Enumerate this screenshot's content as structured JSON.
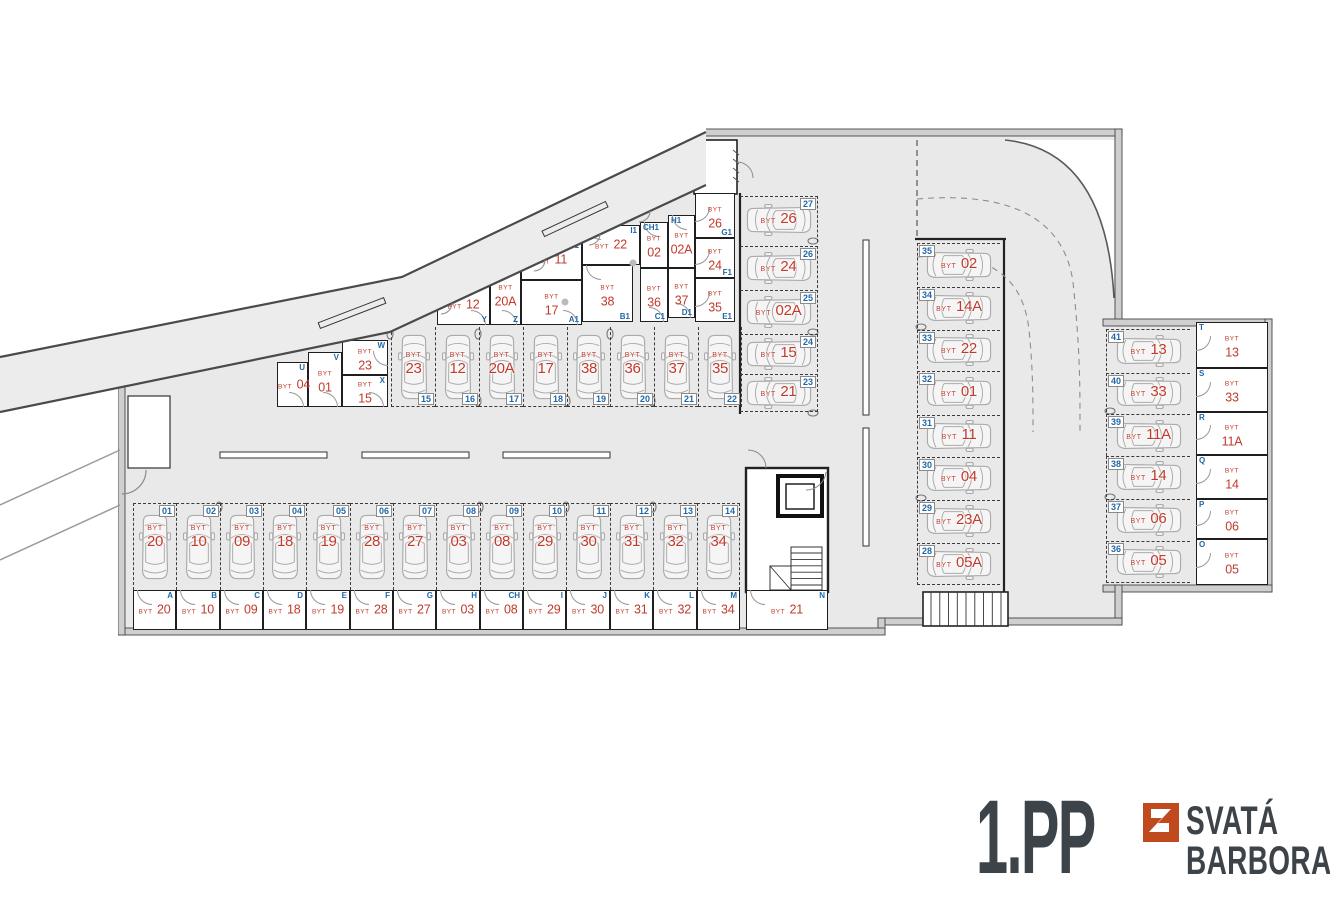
{
  "page": {
    "floor_label": "1.PP",
    "brand_top": "SVATÁ",
    "brand_bottom": "BARBORA"
  },
  "colors": {
    "apt_red": "#c13a2b",
    "code_blue": "#1f67a8",
    "floor_gray": "#e9e9e9",
    "wall_dark": "#3a3a3a",
    "title_gray": "#3d4449",
    "logo_orange": "#c04a1e",
    "car_line": "#ababab"
  },
  "legend": {
    "byt_prefix": "BYT"
  },
  "parking_groups": [
    {
      "id": "row-bottom",
      "orient": "v",
      "chip_pos": "tr",
      "label_mode": "stack",
      "spaces": [
        {
          "num": "01",
          "apt": "20",
          "x": 133,
          "y": 503,
          "w": 43,
          "h": 87
        },
        {
          "num": "02",
          "apt": "10",
          "x": 176,
          "y": 503,
          "w": 44,
          "h": 87
        },
        {
          "num": "03",
          "apt": "09",
          "x": 220,
          "y": 503,
          "w": 43,
          "h": 87
        },
        {
          "num": "04",
          "apt": "18",
          "x": 263,
          "y": 503,
          "w": 43,
          "h": 87
        },
        {
          "num": "05",
          "apt": "19",
          "x": 306,
          "y": 503,
          "w": 44,
          "h": 87
        },
        {
          "num": "06",
          "apt": "28",
          "x": 350,
          "y": 503,
          "w": 43,
          "h": 87
        },
        {
          "num": "07",
          "apt": "27",
          "x": 393,
          "y": 503,
          "w": 43,
          "h": 87
        },
        {
          "num": "08",
          "apt": "03",
          "x": 436,
          "y": 503,
          "w": 44,
          "h": 87
        },
        {
          "num": "09",
          "apt": "08",
          "x": 480,
          "y": 503,
          "w": 43,
          "h": 87
        },
        {
          "num": "10",
          "apt": "29",
          "x": 523,
          "y": 503,
          "w": 43,
          "h": 87
        },
        {
          "num": "11",
          "apt": "30",
          "x": 566,
          "y": 503,
          "w": 44,
          "h": 87
        },
        {
          "num": "12",
          "apt": "31",
          "x": 610,
          "y": 503,
          "w": 43,
          "h": 87
        },
        {
          "num": "13",
          "apt": "32",
          "x": 653,
          "y": 503,
          "w": 44,
          "h": 87
        },
        {
          "num": "14",
          "apt": "34",
          "x": 697,
          "y": 503,
          "w": 43,
          "h": 87
        }
      ]
    },
    {
      "id": "row-middle",
      "orient": "v",
      "chip_pos": "br",
      "label_mode": "stack",
      "spaces": [
        {
          "num": "15",
          "apt": "23",
          "x": 391,
          "y": 327,
          "w": 44,
          "h": 80
        },
        {
          "num": "16",
          "apt": "12",
          "x": 435,
          "y": 327,
          "w": 44,
          "h": 80
        },
        {
          "num": "17",
          "apt": "20A",
          "x": 479,
          "y": 327,
          "w": 44,
          "h": 80
        },
        {
          "num": "18",
          "apt": "17",
          "x": 523,
          "y": 327,
          "w": 44,
          "h": 80
        },
        {
          "num": "19",
          "apt": "38",
          "x": 567,
          "y": 327,
          "w": 43,
          "h": 80
        },
        {
          "num": "20",
          "apt": "36",
          "x": 610,
          "y": 327,
          "w": 44,
          "h": 80
        },
        {
          "num": "21",
          "apt": "37",
          "x": 654,
          "y": 327,
          "w": 44,
          "h": 80
        },
        {
          "num": "22",
          "apt": "35",
          "x": 698,
          "y": 327,
          "w": 44,
          "h": 80
        }
      ]
    },
    {
      "id": "col-inner",
      "orient": "h-left",
      "chip_pos": "tr",
      "label_mode": "inline",
      "spaces": [
        {
          "num": "27",
          "apt": "26",
          "x": 740,
          "y": 196,
          "w": 78,
          "h": 46
        },
        {
          "num": "26",
          "apt": "24",
          "x": 740,
          "y": 246,
          "w": 78,
          "h": 42
        },
        {
          "num": "25",
          "apt": "02A",
          "x": 740,
          "y": 290,
          "w": 78,
          "h": 42
        },
        {
          "num": "24",
          "apt": "15",
          "x": 740,
          "y": 334,
          "w": 78,
          "h": 38
        },
        {
          "num": "23",
          "apt": "21",
          "x": 740,
          "y": 374,
          "w": 78,
          "h": 38
        }
      ]
    },
    {
      "id": "col-right",
      "orient": "h-right",
      "chip_pos": "tl",
      "label_mode": "inline",
      "spaces": [
        {
          "num": "35",
          "apt": "02",
          "x": 917,
          "y": 243,
          "w": 83,
          "h": 42
        },
        {
          "num": "34",
          "apt": "14A",
          "x": 917,
          "y": 287,
          "w": 83,
          "h": 41
        },
        {
          "num": "33",
          "apt": "22",
          "x": 917,
          "y": 330,
          "w": 83,
          "h": 39
        },
        {
          "num": "32",
          "apt": "01",
          "x": 917,
          "y": 371,
          "w": 83,
          "h": 42
        },
        {
          "num": "31",
          "apt": "11",
          "x": 917,
          "y": 415,
          "w": 83,
          "h": 40
        },
        {
          "num": "30",
          "apt": "04",
          "x": 917,
          "y": 457,
          "w": 83,
          "h": 41
        },
        {
          "num": "29",
          "apt": "23A",
          "x": 917,
          "y": 500,
          "w": 83,
          "h": 41
        },
        {
          "num": "28",
          "apt": "05A",
          "x": 917,
          "y": 543,
          "w": 83,
          "h": 42
        }
      ]
    },
    {
      "id": "col-far",
      "orient": "h-right",
      "chip_pos": "tl",
      "label_mode": "inline",
      "spaces": [
        {
          "num": "41",
          "apt": "13",
          "x": 1106,
          "y": 329,
          "w": 84,
          "h": 42
        },
        {
          "num": "40",
          "apt": "33",
          "x": 1106,
          "y": 373,
          "w": 84,
          "h": 39
        },
        {
          "num": "39",
          "apt": "11A",
          "x": 1106,
          "y": 414,
          "w": 84,
          "h": 42
        },
        {
          "num": "38",
          "apt": "14",
          "x": 1106,
          "y": 456,
          "w": 84,
          "h": 41
        },
        {
          "num": "37",
          "apt": "06",
          "x": 1106,
          "y": 499,
          "w": 84,
          "h": 40
        },
        {
          "num": "36",
          "apt": "05",
          "x": 1106,
          "y": 541,
          "w": 84,
          "h": 42
        }
      ]
    }
  ],
  "storage_groups": [
    {
      "id": "cellars-diagonal",
      "rooms": [
        {
          "code": "U",
          "apt": "04",
          "x": 277,
          "y": 362,
          "w": 31,
          "h": 45,
          "label_mode": "inline",
          "letter_pos": "tr",
          "door": "bottom"
        },
        {
          "code": "V",
          "apt": "01",
          "x": 308,
          "y": 352,
          "w": 34,
          "h": 55,
          "label_mode": "stack",
          "letter_pos": "tr",
          "door": "bottom"
        },
        {
          "code": "W",
          "apt": "23",
          "x": 342,
          "y": 340,
          "w": 46,
          "h": 35,
          "label_mode": "stack",
          "letter_pos": "tr",
          "door": "right"
        },
        {
          "code": "X",
          "apt": "15",
          "x": 342,
          "y": 375,
          "w": 46,
          "h": 32,
          "label_mode": "stack",
          "letter_pos": "tr",
          "door": "bottom"
        },
        {
          "code": "Y",
          "apt": "12",
          "x": 437,
          "y": 285,
          "w": 53,
          "h": 40,
          "label_mode": "inline",
          "letter_pos": "br",
          "door": "bottom"
        },
        {
          "code": "Z",
          "apt": "20A",
          "x": 490,
          "y": 262,
          "w": 31,
          "h": 63,
          "label_mode": "stack",
          "letter_pos": "br",
          "door": "bottom"
        },
        {
          "code": "J1",
          "apt": "11",
          "x": 521,
          "y": 240,
          "w": 61,
          "h": 40,
          "label_mode": "inline",
          "letter_pos": "tr",
          "door": "top"
        },
        {
          "code": "A1",
          "apt": "17",
          "x": 521,
          "y": 280,
          "w": 61,
          "h": 45,
          "label_mode": "stack",
          "letter_pos": "br",
          "door": "bottom"
        },
        {
          "code": "I1",
          "apt": "22",
          "x": 582,
          "y": 225,
          "w": 58,
          "h": 40,
          "label_mode": "inline",
          "letter_pos": "tr",
          "door": "top"
        },
        {
          "code": "B1",
          "apt": "38",
          "x": 582,
          "y": 265,
          "w": 51,
          "h": 57,
          "label_mode": "stack",
          "letter_pos": "br",
          "door": "top"
        },
        {
          "code": "CH1",
          "apt": "02",
          "x": 640,
          "y": 222,
          "w": 28,
          "h": 46,
          "label_mode": "stack",
          "letter_pos": "tl",
          "door": "top"
        },
        {
          "code": "C1",
          "apt": "36",
          "x": 640,
          "y": 268,
          "w": 28,
          "h": 54,
          "label_mode": "stack",
          "letter_pos": "br",
          "door": "bottom"
        },
        {
          "code": "H1",
          "apt": "02A",
          "x": 668,
          "y": 215,
          "w": 27,
          "h": 53,
          "label_mode": "stack",
          "letter_pos": "tl",
          "door": "top"
        },
        {
          "code": "D1",
          "apt": "37",
          "x": 668,
          "y": 268,
          "w": 27,
          "h": 50,
          "label_mode": "stack",
          "letter_pos": "br",
          "door": "bottom"
        },
        {
          "code": "G1",
          "apt": "26",
          "x": 695,
          "y": 193,
          "w": 40,
          "h": 45,
          "label_mode": "stack",
          "letter_pos": "br",
          "door": "left"
        },
        {
          "code": "F1",
          "apt": "24",
          "x": 695,
          "y": 238,
          "w": 40,
          "h": 40,
          "label_mode": "stack",
          "letter_pos": "br",
          "door": "left"
        },
        {
          "code": "E1",
          "apt": "35",
          "x": 695,
          "y": 278,
          "w": 40,
          "h": 44,
          "label_mode": "stack",
          "letter_pos": "br",
          "door": "left"
        }
      ]
    },
    {
      "id": "cellars-bottom",
      "rooms": [
        {
          "code": "A",
          "apt": "20",
          "x": 133,
          "y": 590,
          "w": 43,
          "h": 40,
          "label_mode": "inline",
          "letter_pos": "tr",
          "door": "top"
        },
        {
          "code": "B",
          "apt": "10",
          "x": 176,
          "y": 590,
          "w": 44,
          "h": 40,
          "label_mode": "inline",
          "letter_pos": "tr",
          "door": "top"
        },
        {
          "code": "C",
          "apt": "09",
          "x": 220,
          "y": 590,
          "w": 43,
          "h": 40,
          "label_mode": "inline",
          "letter_pos": "tr",
          "door": "top"
        },
        {
          "code": "D",
          "apt": "18",
          "x": 263,
          "y": 590,
          "w": 43,
          "h": 40,
          "label_mode": "inline",
          "letter_pos": "tr",
          "door": "top"
        },
        {
          "code": "E",
          "apt": "19",
          "x": 306,
          "y": 590,
          "w": 44,
          "h": 40,
          "label_mode": "inline",
          "letter_pos": "tr",
          "door": "top"
        },
        {
          "code": "F",
          "apt": "28",
          "x": 350,
          "y": 590,
          "w": 43,
          "h": 40,
          "label_mode": "inline",
          "letter_pos": "tr",
          "door": "top"
        },
        {
          "code": "G",
          "apt": "27",
          "x": 393,
          "y": 590,
          "w": 43,
          "h": 40,
          "label_mode": "inline",
          "letter_pos": "tr",
          "door": "top"
        },
        {
          "code": "H",
          "apt": "03",
          "x": 436,
          "y": 590,
          "w": 44,
          "h": 40,
          "label_mode": "inline",
          "letter_pos": "tr",
          "door": "top"
        },
        {
          "code": "CH",
          "apt": "08",
          "x": 480,
          "y": 590,
          "w": 43,
          "h": 40,
          "label_mode": "inline",
          "letter_pos": "tr",
          "door": "top"
        },
        {
          "code": "I",
          "apt": "29",
          "x": 523,
          "y": 590,
          "w": 43,
          "h": 40,
          "label_mode": "inline",
          "letter_pos": "tr",
          "door": "top"
        },
        {
          "code": "J",
          "apt": "30",
          "x": 566,
          "y": 590,
          "w": 44,
          "h": 40,
          "label_mode": "inline",
          "letter_pos": "tr",
          "door": "top"
        },
        {
          "code": "K",
          "apt": "31",
          "x": 610,
          "y": 590,
          "w": 43,
          "h": 40,
          "label_mode": "inline",
          "letter_pos": "tr",
          "door": "top"
        },
        {
          "code": "L",
          "apt": "32",
          "x": 653,
          "y": 590,
          "w": 44,
          "h": 40,
          "label_mode": "inline",
          "letter_pos": "tr",
          "door": "top"
        },
        {
          "code": "M",
          "apt": "34",
          "x": 697,
          "y": 590,
          "w": 43,
          "h": 40,
          "label_mode": "inline",
          "letter_pos": "tr",
          "door": "top"
        },
        {
          "code": "N",
          "apt": "21",
          "x": 746,
          "y": 590,
          "w": 82,
          "h": 40,
          "label_mode": "inline",
          "letter_pos": "tr",
          "door": "top"
        }
      ]
    },
    {
      "id": "cellars-right",
      "rooms": [
        {
          "code": "T",
          "apt": "13",
          "x": 1196,
          "y": 322,
          "w": 72,
          "h": 46,
          "label_mode": "stack",
          "letter_pos": "tl",
          "door": "left"
        },
        {
          "code": "S",
          "apt": "33",
          "x": 1196,
          "y": 368,
          "w": 72,
          "h": 44,
          "label_mode": "stack",
          "letter_pos": "tl",
          "door": "left"
        },
        {
          "code": "R",
          "apt": "11A",
          "x": 1196,
          "y": 412,
          "w": 72,
          "h": 43,
          "label_mode": "stack",
          "letter_pos": "tl",
          "door": "left"
        },
        {
          "code": "Q",
          "apt": "14",
          "x": 1196,
          "y": 455,
          "w": 72,
          "h": 44,
          "label_mode": "stack",
          "letter_pos": "tl",
          "door": "left"
        },
        {
          "code": "P",
          "apt": "06",
          "x": 1196,
          "y": 499,
          "w": 72,
          "h": 40,
          "label_mode": "stack",
          "letter_pos": "tl",
          "door": "left"
        },
        {
          "code": "O",
          "apt": "05",
          "x": 1196,
          "y": 539,
          "w": 72,
          "h": 46,
          "label_mode": "stack",
          "letter_pos": "tl",
          "door": "left"
        }
      ]
    }
  ]
}
